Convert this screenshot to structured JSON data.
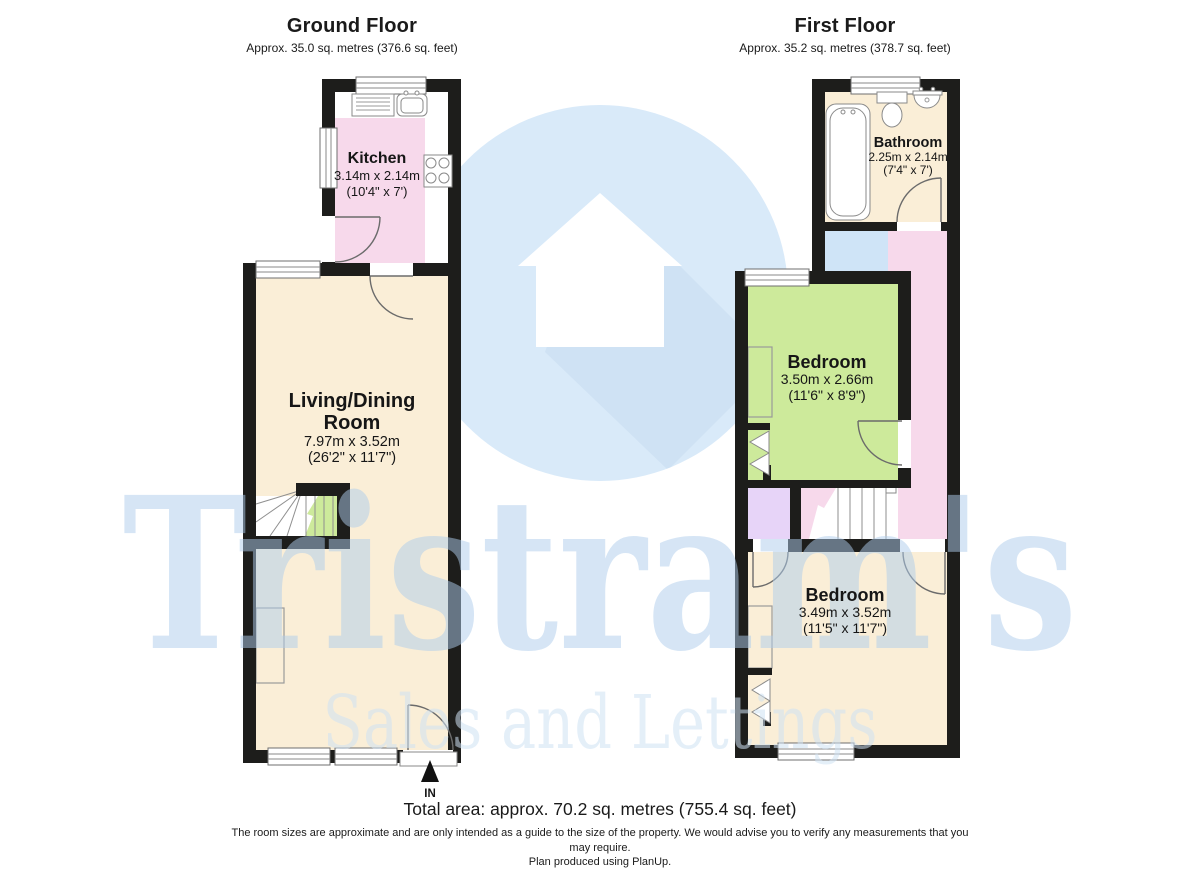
{
  "ground_floor": {
    "title": "Ground Floor",
    "area": "Approx. 35.0 sq. metres (376.6 sq. feet)",
    "entrance_label": "IN",
    "rooms": [
      {
        "name": "Kitchen",
        "lines": [
          "Kitchen"
        ],
        "dims_m": "3.14m x 2.14m",
        "dims_ft": "(10'4\" x 7')"
      },
      {
        "name": "Living/Dining Room",
        "lines": [
          "Living/Dining",
          "Room"
        ],
        "dims_m": "7.97m x 3.52m",
        "dims_ft": "(26'2\" x 11'7\")"
      }
    ]
  },
  "first_floor": {
    "title": "First Floor",
    "area": "Approx. 35.2 sq. metres (378.7 sq. feet)",
    "rooms": [
      {
        "name": "Bathroom",
        "lines": [
          "Bathroom"
        ],
        "dims_m": "2.25m x 2.14m",
        "dims_ft": "(7'4\" x 7')"
      },
      {
        "name": "Bedroom",
        "lines": [
          "Bedroom"
        ],
        "dims_m": "3.50m x 2.66m",
        "dims_ft": "(11'6\" x 8'9\")"
      },
      {
        "name": "Bedroom",
        "lines": [
          "Bedroom"
        ],
        "dims_m": "3.49m x 3.52m",
        "dims_ft": "(11'5\" x 11'7\")"
      }
    ]
  },
  "footer": {
    "total_area": "Total area: approx. 70.2 sq. metres (755.4 sq. feet)",
    "disclaimer_line1": "The room sizes are approximate and are only intended as a guide to the size of the property. We would advise you to verify any measurements that you",
    "disclaimer_line2": "may require.",
    "disclaimer_line3": "Plan produced using PlanUp."
  },
  "watermark": {
    "brand": "Tristram's",
    "tagline": "Sales and Lettings",
    "icon": "house-icon"
  },
  "colors": {
    "wall": "#1d1d1b",
    "cream": "#faeed7",
    "pink": "#f7d9eb",
    "green": "#cdea9b",
    "blue": "#cfe4f7",
    "lavender": "#e7d4f8",
    "wm_circle": "#d9eaf9",
    "wm_shadow": "#cfe2f4",
    "wm_house": "#ffffff",
    "wm_text": "#aecdec",
    "wm_tagline": "#cfe2f4"
  }
}
